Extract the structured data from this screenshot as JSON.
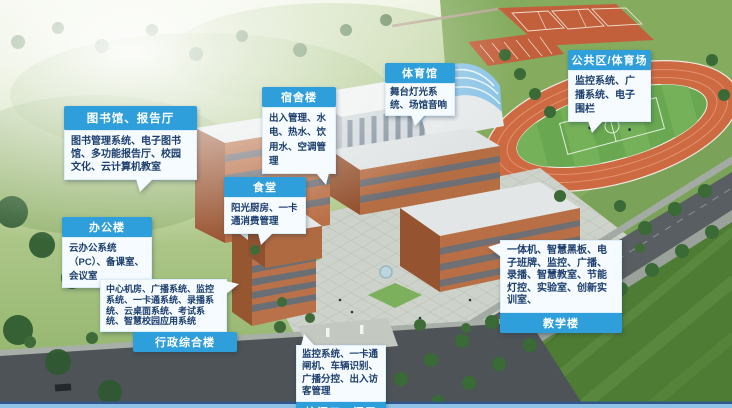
{
  "callouts": [
    {
      "id": "library-hall",
      "title": "图书馆、报告厅",
      "body": "图书管理系统、电子图书馆、多功能报告厅、校园文化、云计算机教室",
      "title_position": "top"
    },
    {
      "id": "office-building",
      "title": "办公楼",
      "body": "云办公系统（PC）、备课室、会议室",
      "title_position": "top"
    },
    {
      "id": "dormitory",
      "title": "宿舍楼",
      "body": "出入管理、水电、热水、饮用水、空调管理",
      "title_position": "top"
    },
    {
      "id": "canteen",
      "title": "食堂",
      "body": "阳光厨房、一卡通消费管理",
      "title_position": "top"
    },
    {
      "id": "gymnasium",
      "title": "体育馆",
      "body": "舞台灯光系统、场馆音响",
      "title_position": "top"
    },
    {
      "id": "public-stadium",
      "title": "公共区/体育场",
      "body": "监控系统、广播系统、电子围栏",
      "title_position": "top"
    },
    {
      "id": "admin-complex",
      "title": "行政综合楼",
      "body": "中心机房、广播系统、监控系统、一卡通系统、录播系统、云桌面系统、考试系统、智慧校园应用系统",
      "title_position": "bottom"
    },
    {
      "id": "school-gate",
      "title": "校门口、门卫",
      "body": "监控系统、一卡通闸机、车辆识别、广播分控、出入访客管理",
      "title_position": "bottom"
    },
    {
      "id": "teaching-building",
      "title": "教学楼",
      "body": "一体机、智慧黑板、电子班牌、监控、广播、录播、智慧教室、节能灯控、实验室、创新实训室、",
      "title_position": "bottom"
    }
  ],
  "colors": {
    "callout_header": "#2e9fdb",
    "callout_body_bg": "#f5fbff",
    "callout_text": "#1d3f6e",
    "header_text": "#ffffff",
    "bottom_bar_dark": "#31568a",
    "bottom_bar_light": "#8fc2e8",
    "track_orange": "#ce6a42",
    "field_green": "#69a750"
  },
  "scene": {
    "labeled_buildings": [
      "图书馆、报告厅",
      "办公楼",
      "宿舍楼",
      "食堂",
      "体育馆",
      "公共区/体育场",
      "行政综合楼",
      "校门口、门卫",
      "教学楼"
    ]
  }
}
